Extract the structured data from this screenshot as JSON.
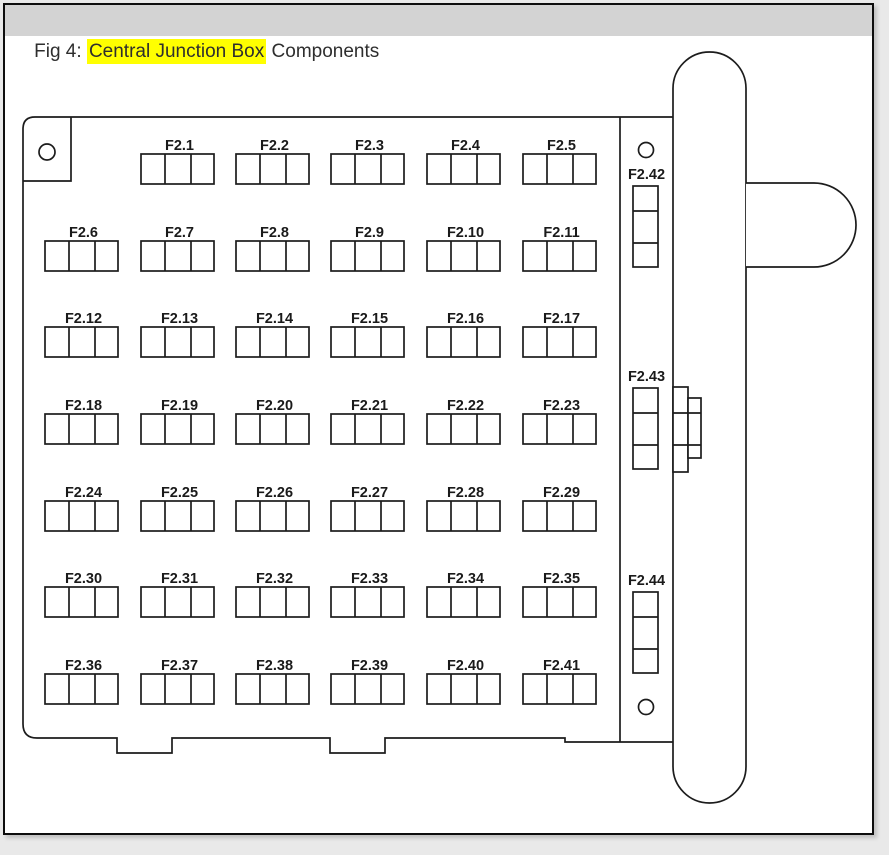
{
  "header": {
    "prefix": "Fig 4: ",
    "highlight": "Central Junction Box",
    "suffix": " Components",
    "highlight_color": "#ffff00",
    "bar_color": "#d3d3d3",
    "text_color": "#2e2e2e"
  },
  "diagram": {
    "stroke_color": "#1c1c1c",
    "fuse_rows": [
      {
        "start_col": 1,
        "labels": [
          "F2.1",
          "F2.2",
          "F2.3",
          "F2.4",
          "F2.5"
        ]
      },
      {
        "start_col": 0,
        "labels": [
          "F2.6",
          "F2.7",
          "F2.8",
          "F2.9",
          "F2.10",
          "F2.11"
        ]
      },
      {
        "start_col": 0,
        "labels": [
          "F2.12",
          "F2.13",
          "F2.14",
          "F2.15",
          "F2.16",
          "F2.17"
        ]
      },
      {
        "start_col": 0,
        "labels": [
          "F2.18",
          "F2.19",
          "F2.20",
          "F2.21",
          "F2.22",
          "F2.23"
        ]
      },
      {
        "start_col": 0,
        "labels": [
          "F2.24",
          "F2.25",
          "F2.26",
          "F2.27",
          "F2.28",
          "F2.29"
        ]
      },
      {
        "start_col": 0,
        "labels": [
          "F2.30",
          "F2.31",
          "F2.32",
          "F2.33",
          "F2.34",
          "F2.35"
        ]
      },
      {
        "start_col": 0,
        "labels": [
          "F2.36",
          "F2.37",
          "F2.38",
          "F2.39",
          "F2.40",
          "F2.41"
        ]
      }
    ],
    "side_fuses": [
      "F2.42",
      "F2.43",
      "F2.44"
    ]
  }
}
